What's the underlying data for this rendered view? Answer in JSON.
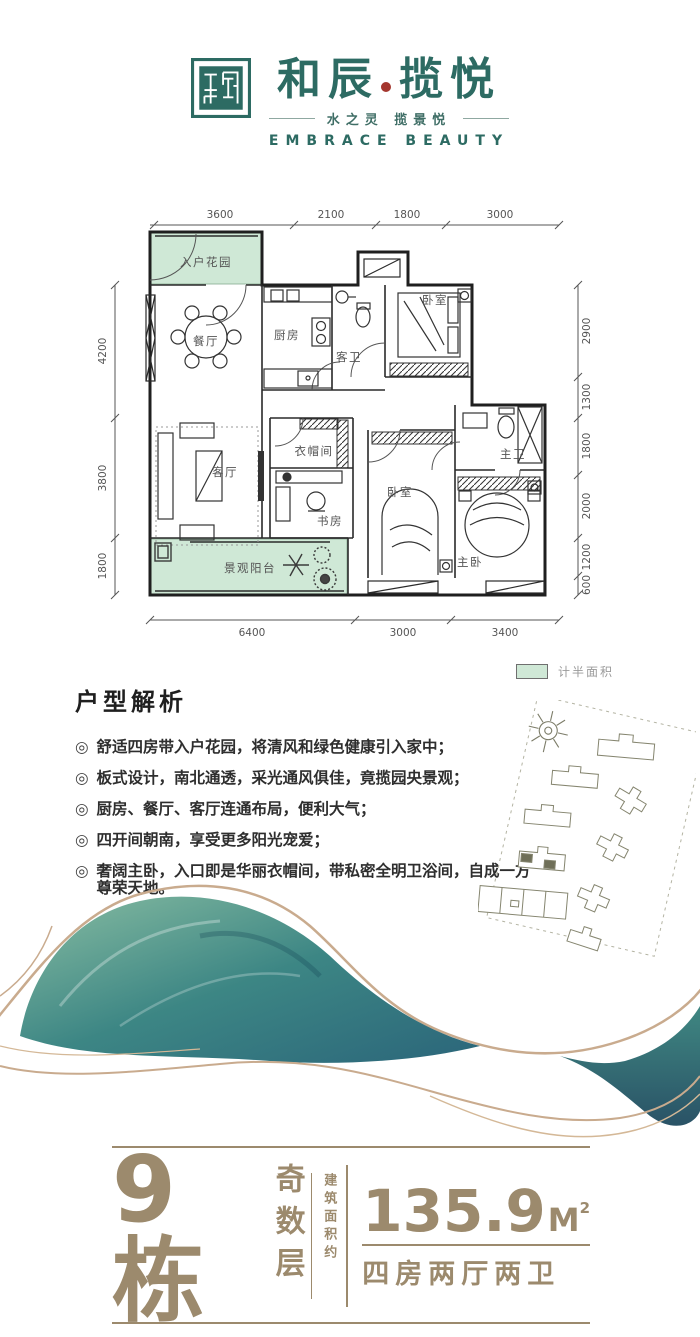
{
  "header": {
    "brand_first": "和辰",
    "brand_second": "揽悦",
    "subtitle_cn": "水之灵  揽景悦",
    "subtitle_en": "EMBRACE BEAUTY"
  },
  "floorplan": {
    "rooms": [
      {
        "label": "入户花园"
      },
      {
        "label": "餐厅"
      },
      {
        "label": "厨房"
      },
      {
        "label": "客卫"
      },
      {
        "label": "卧室"
      },
      {
        "label": "客厅"
      },
      {
        "label": "衣帽间"
      },
      {
        "label": "书房"
      },
      {
        "label": "卧室"
      },
      {
        "label": "主卫"
      },
      {
        "label": "主卧"
      },
      {
        "label": "景观阳台"
      }
    ],
    "dims_top": [
      "3600",
      "2100",
      "1800",
      "3000"
    ],
    "dims_right": [
      "2900",
      "1300",
      "1800",
      "2000",
      "1200",
      "600"
    ],
    "dims_bottom": [
      "6400",
      "3000",
      "3400"
    ],
    "dims_left": [
      "4200",
      "3800",
      "1800"
    ],
    "legend_label": "计半面积"
  },
  "analysis": {
    "title": "户型解析",
    "bullet_mark": "◎",
    "bullets": [
      "舒适四房带入户花园，将清风和绿色健康引入家中；",
      "板式设计，南北通透，采光通风俱佳，竟揽园央景观；",
      "厨房、餐厅、客厅连通布局，便利大气；",
      "四开间朝南，享受更多阳光宠爱；",
      "奢阔主卧，入口即是华丽衣帽间，带私密全明卫浴间，自成一方尊荣天地。"
    ]
  },
  "footer": {
    "building": "9栋",
    "floor_type": "奇数层",
    "area_label": "建筑面积约",
    "area_value": "135.9",
    "area_unit": "M",
    "area_sup": "2",
    "layout": "四房两厅两卫"
  },
  "colors": {
    "brand_teal": "#2d6b63",
    "accent_red": "#a4362e",
    "tan": "#9c8a6d",
    "plan_green": "#cfe8d6"
  }
}
